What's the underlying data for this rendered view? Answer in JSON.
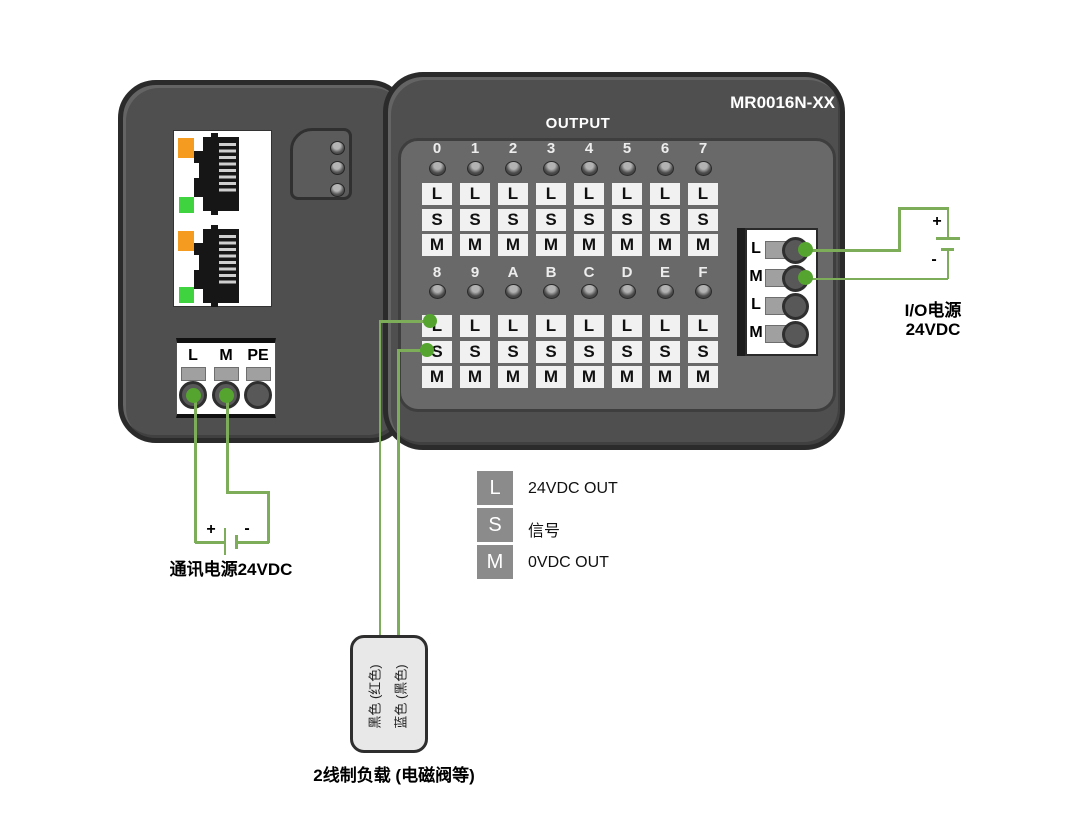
{
  "title": {
    "model": "MR0016N-XX",
    "section": "OUTPUT"
  },
  "output_grid": {
    "rows": [
      {
        "channels": [
          "0",
          "1",
          "2",
          "3",
          "4",
          "5",
          "6",
          "7"
        ]
      },
      {
        "channels": [
          "8",
          "9",
          "A",
          "B",
          "C",
          "D",
          "E",
          "F"
        ]
      }
    ],
    "terminal_labels": [
      "L",
      "S",
      "M"
    ]
  },
  "io_power_block": {
    "terminals": [
      "L",
      "M",
      "L",
      "M"
    ]
  },
  "comm_block": {
    "terminals": [
      "L",
      "M",
      "PE"
    ]
  },
  "legend": {
    "items": [
      {
        "key": "L",
        "label": "24VDC OUT"
      },
      {
        "key": "S",
        "label": "信号"
      },
      {
        "key": "M",
        "label": "0VDC OUT"
      }
    ]
  },
  "power_supplies": {
    "comm": {
      "label": "通讯电源24VDC",
      "plus": "+",
      "minus": "-"
    },
    "io": {
      "label_line1": "I/O电源",
      "label_line2": "24VDC",
      "plus": "+",
      "minus": "-"
    }
  },
  "load": {
    "label": "2线制负载 (电磁阀等)",
    "wire_labels": [
      "黑色 (红色)",
      "蓝色 (黑色)"
    ]
  },
  "colors": {
    "wire": "#7dad58",
    "terminal_dot": "#55a430",
    "led_orange": "#f49b20",
    "led_green": "#3fd33f"
  }
}
